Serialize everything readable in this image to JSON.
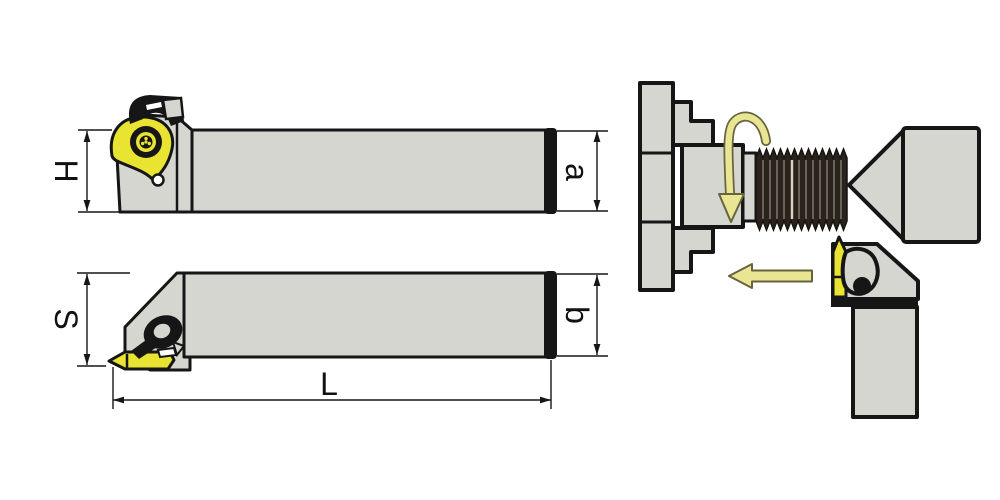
{
  "labels": {
    "H": "H",
    "a": "a",
    "S": "S",
    "b": "b",
    "L": "L"
  },
  "colors": {
    "background": "#ffffff",
    "holder_gray": "#d6d6d1",
    "outline": "#161616",
    "insert_yellow": "#e9e332",
    "arrow_yellow": "#e9e593",
    "arrow_outline": "#66643f",
    "thread_dark": "#2a231c",
    "thread_streak": "#8a8578",
    "thread_highlight": "#d8d3c4"
  }
}
